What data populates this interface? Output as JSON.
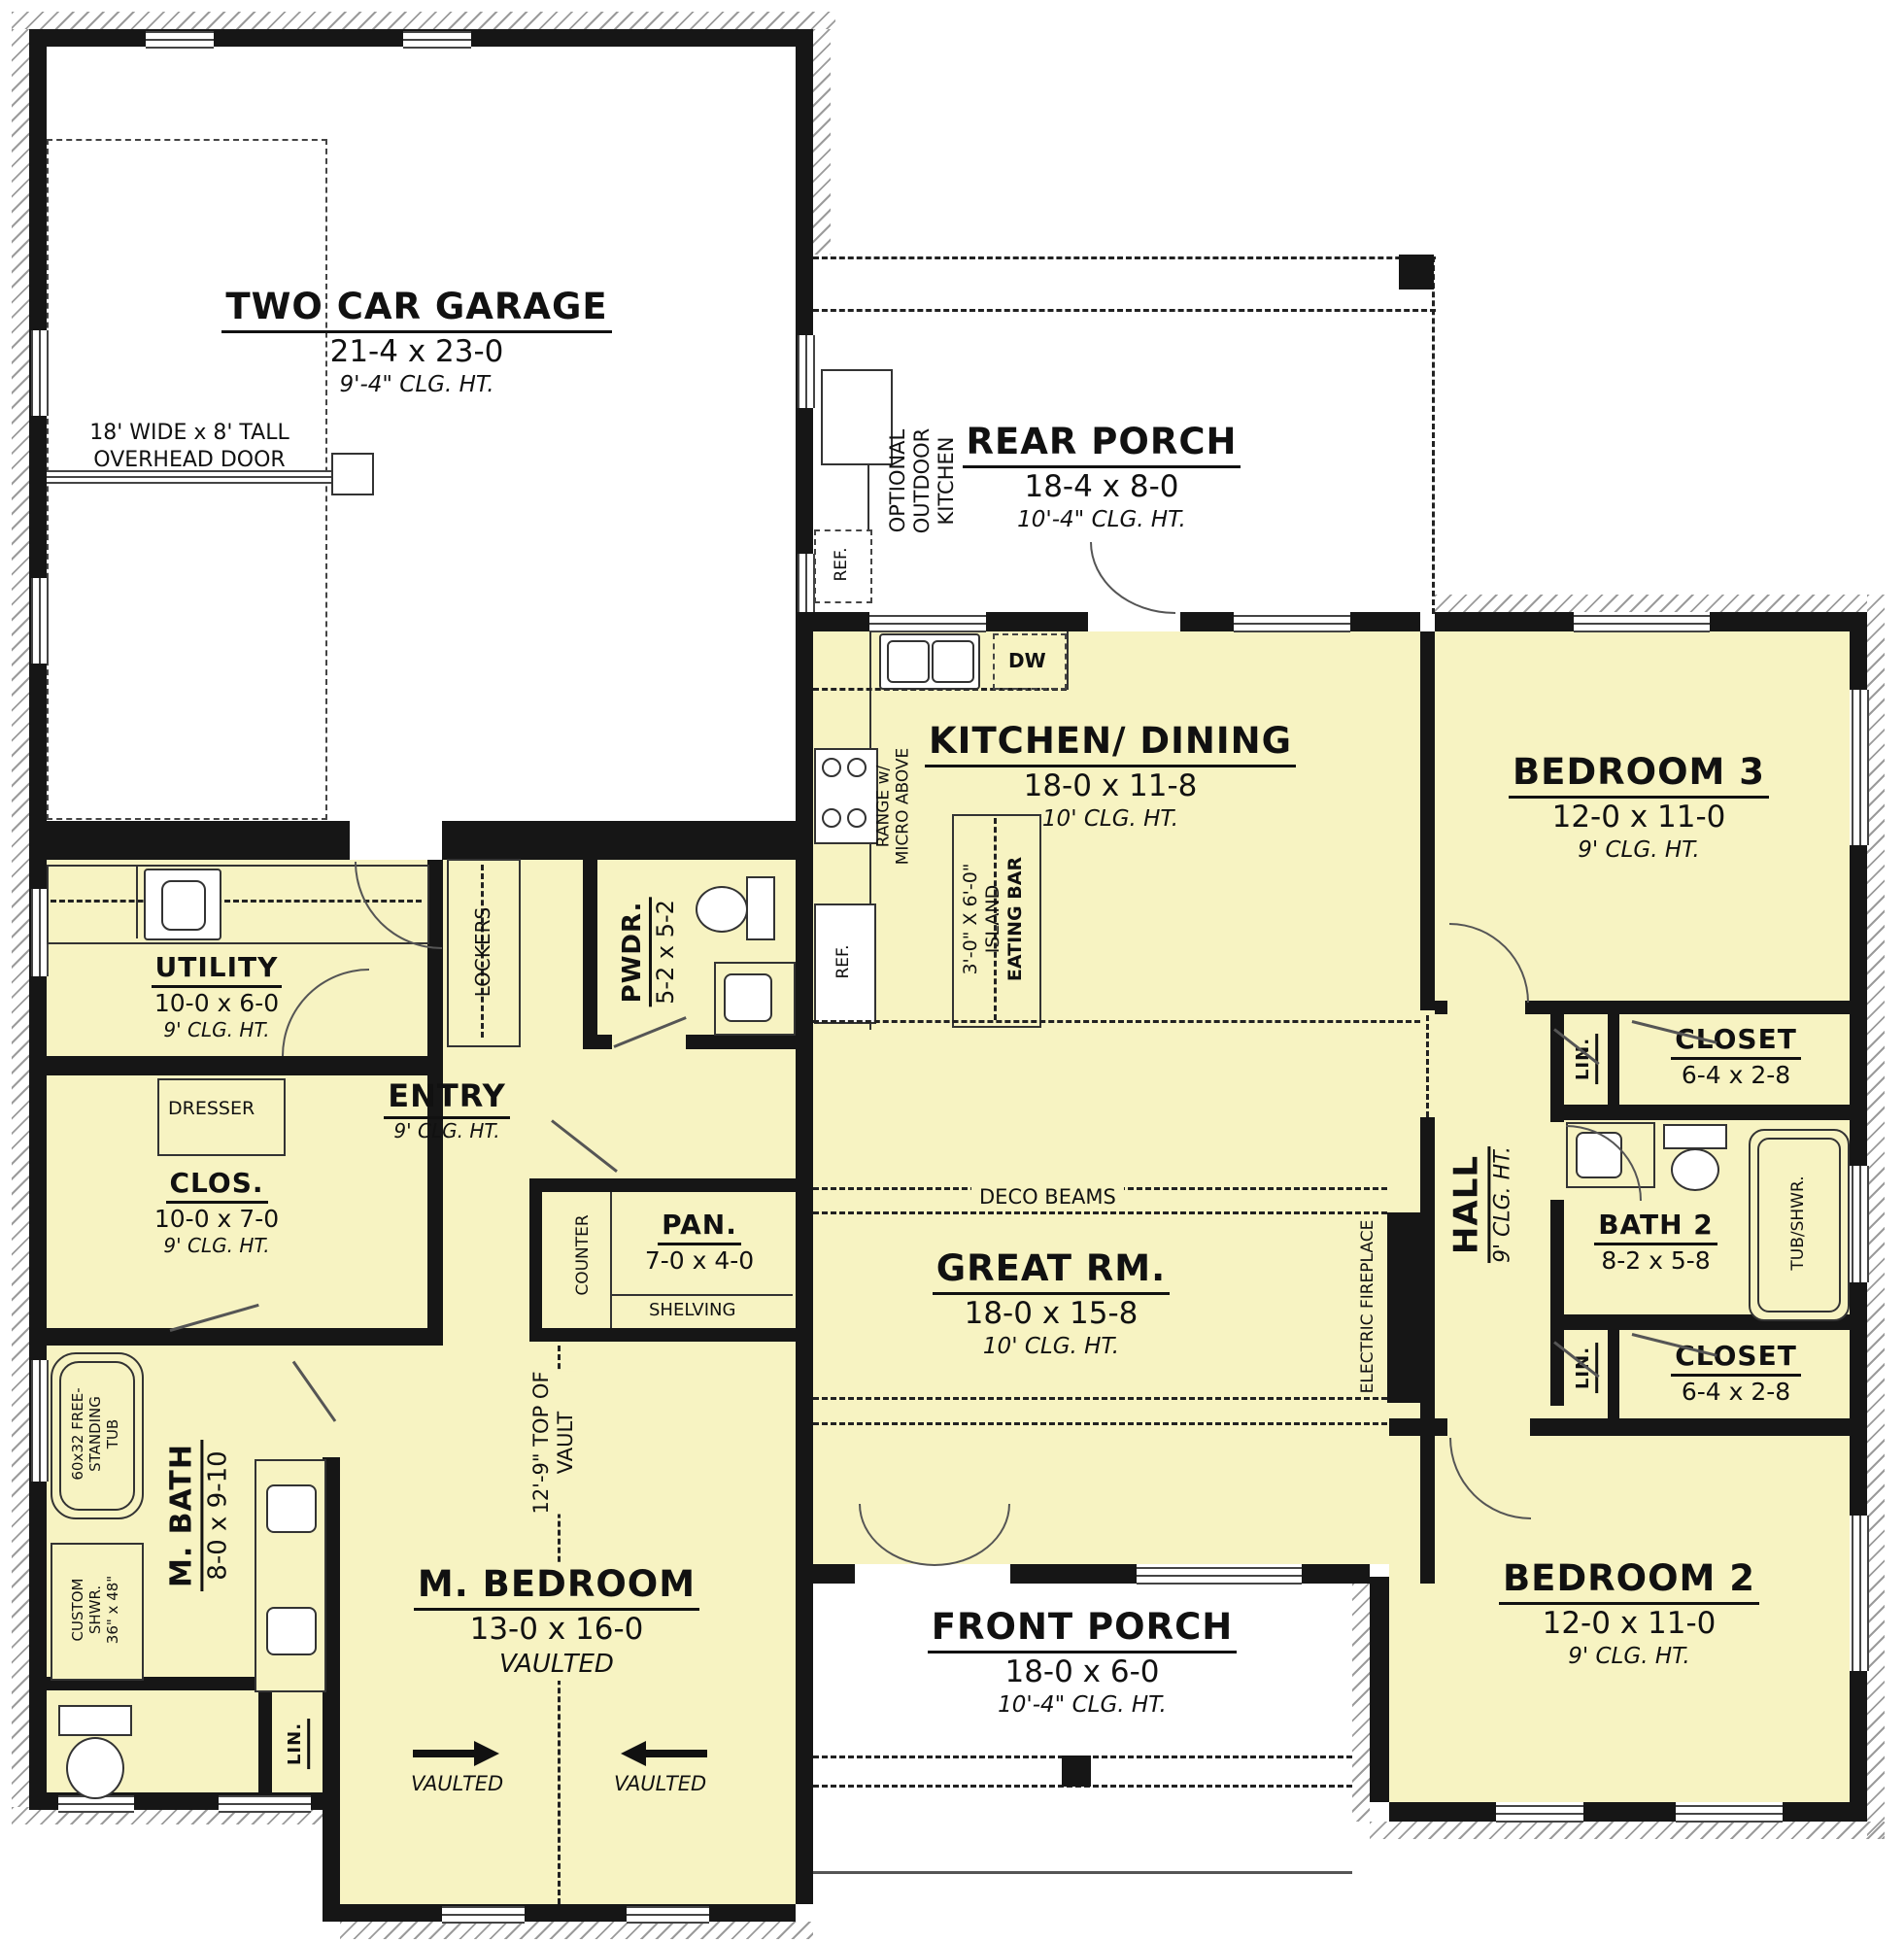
{
  "palette": {
    "room_fill": "#f7f3c2",
    "wall_color": "#161616",
    "line_color": "#333333",
    "paper": "#ffffff"
  },
  "rooms": {
    "garage": {
      "name": "TWO CAR GARAGE",
      "dims": "21-4 x 23-0",
      "clg": "9'-4\" CLG. HT."
    },
    "rear_porch": {
      "name": "REAR PORCH",
      "dims": "18-4 x 8-0",
      "clg": "10'-4\" CLG. HT."
    },
    "kitchen": {
      "name": "KITCHEN/ DINING",
      "dims": "18-0 x 11-8",
      "clg": "10' CLG. HT."
    },
    "bedroom3": {
      "name": "BEDROOM 3",
      "dims": "12-0 x 11-0",
      "clg": "9' CLG. HT."
    },
    "utility": {
      "name": "UTILITY",
      "dims": "10-0 x 6-0",
      "clg": "9' CLG. HT."
    },
    "pwdr": {
      "name": "PWDR.",
      "dims": "5-2 x 5-2"
    },
    "entry": {
      "name": "ENTRY",
      "clg": "9' CLG. HT."
    },
    "clos": {
      "name": "CLOS.",
      "dims": "10-0 x 7-0",
      "clg": "9' CLG. HT."
    },
    "pan": {
      "name": "PAN.",
      "dims": "7-0 x 4-0"
    },
    "great": {
      "name": "GREAT RM.",
      "dims": "18-0 x 15-8",
      "clg": "10' CLG. HT."
    },
    "hall": {
      "name": "HALL",
      "clg": "9' CLG. HT."
    },
    "closet_top": {
      "name": "CLOSET",
      "dims": "6-4 x 2-8"
    },
    "bath2": {
      "name": "BATH 2",
      "dims": "8-2 x 5-8"
    },
    "closet_bot": {
      "name": "CLOSET",
      "dims": "6-4 x 2-8"
    },
    "bedroom2": {
      "name": "BEDROOM 2",
      "dims": "12-0 x 11-0",
      "clg": "9' CLG. HT."
    },
    "mbath": {
      "name": "M. BATH",
      "dims": "8-0 x 9-10"
    },
    "mbed": {
      "name": "M. BEDROOM",
      "dims": "13-0 x 16-0",
      "note": "VAULTED"
    },
    "front_porch": {
      "name": "FRONT PORCH",
      "dims": "18-0 x 6-0",
      "clg": "10'-4\" CLG. HT."
    }
  },
  "labels": {
    "overhead_door": [
      "18' WIDE x 8' TALL",
      "OVERHEAD DOOR"
    ],
    "outdoor_kitchen": [
      "OPTIONAL",
      "OUTDOOR",
      "KITCHEN"
    ],
    "ref_porch": "REF.",
    "dw": "DW",
    "range": [
      "RANGE w/",
      "MICRO ABOVE"
    ],
    "ref_kitchen": "REF.",
    "island": [
      "3'-0\" X 6'-0\"",
      "ISLAND",
      "EATING BAR"
    ],
    "deco_beams": "DECO BEAMS",
    "electric_fireplace": "ELECTRIC FIREPLACE",
    "lockers": "LOCKERS",
    "dresser": "DRESSER",
    "counter": "COUNTER",
    "shelving": "SHELVING",
    "lin": "LIN.",
    "tub_shwr": "TUB/SHWR.",
    "free_tub": [
      "60x32 FREE-",
      "STANDING",
      "TUB"
    ],
    "custom_shwr": [
      "CUSTOM",
      "SHWR.",
      "36\" x 48\""
    ],
    "vault": [
      "12'-9\" TOP OF",
      "VAULT"
    ],
    "vaulted": "VAULTED"
  }
}
